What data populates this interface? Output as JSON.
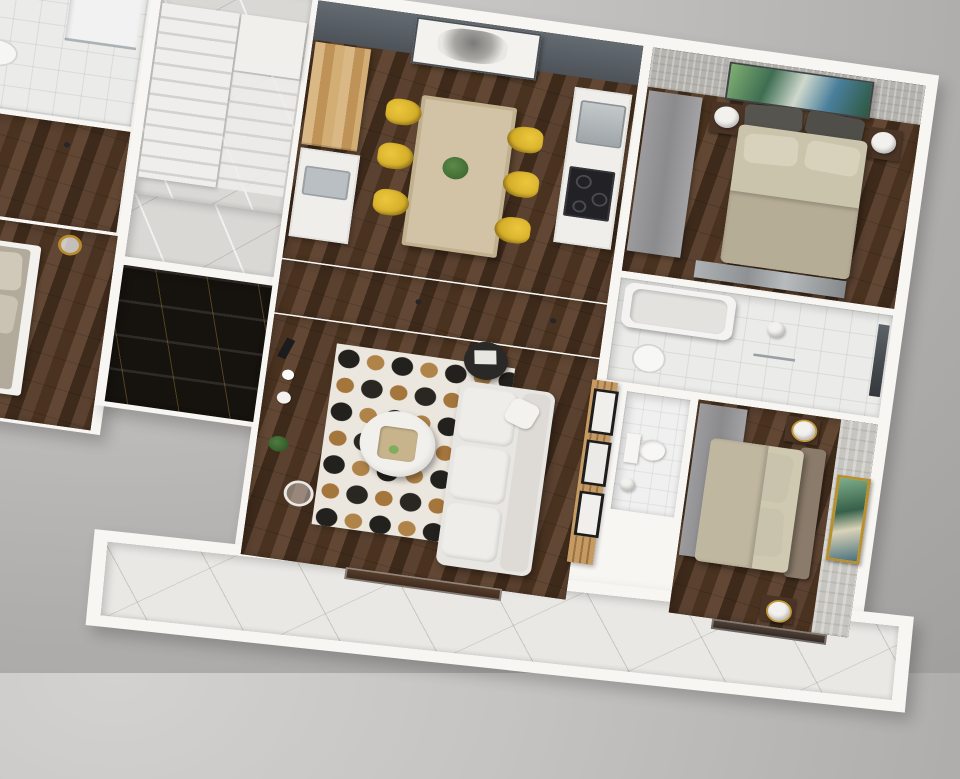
{
  "meta": {
    "description": "Photorealistic 3D top-down dollhouse render of an apartment floor plan on a gray studio backdrop",
    "view": "top-down 3D cutaway, plan rotated about 10 degrees clockwise",
    "visible_text": "none"
  },
  "palette": {
    "backdrop_gray_top": "#d4d2d0",
    "backdrop_gray_bottom": "#a09e9c",
    "wall_white": "#f7f6f3",
    "wood_floor_dark": "#4e3727",
    "accent_wall_slate": "#575e65",
    "chair_yellow": "#e1ba2e",
    "dining_table_wood": "#d2c3a6",
    "kitchen_cabinet_wood": "#cda774",
    "bedding_khaki": "#cbc4ac",
    "headboard_brown": "#8b7b6a",
    "wardrobe_gray": "#939395",
    "rug_base": "#ece7de",
    "rug_hex_black": "#23211e",
    "rug_hex_gold": "#b08449",
    "sofa_white": "#e8e6e2",
    "marble_light": "#eae8e5",
    "black_marble": "#16120e",
    "plant_green": "#2f5427",
    "art_gold_frame": "#b8912e"
  },
  "scene": {
    "rooms": [
      {
        "name": "neighbor-bathroom",
        "floor": "white tile",
        "items": [
          "vanity with basin",
          "leaning mirror",
          "shower tray"
        ]
      },
      {
        "name": "neighbor-hall",
        "floor": "dark wood",
        "items": [
          "white door"
        ]
      },
      {
        "name": "neighbor-bedroom",
        "floor": "dark wood",
        "items": [
          "gray double bed",
          "gold wire lamps",
          "white nightstand"
        ]
      },
      {
        "name": "stair-hall",
        "floor": "light marble",
        "items": [
          "white L-shaped staircase",
          "landing"
        ]
      },
      {
        "name": "stair-landing-corridor",
        "floor": "gray marble"
      },
      {
        "name": "stairwell-void",
        "floor": "black marble steps with gold veining",
        "items": [
          "glass railing"
        ]
      },
      {
        "name": "dining-kitchen",
        "floor": "dark walnut planks",
        "items": [
          "slate accent wall",
          "black-and-white portrait artwork",
          "tall wood cabinets",
          "white counter with sink",
          "counter with steel sink and black cooktop",
          "light wood dining table",
          "six yellow chairs",
          "green table plant"
        ]
      },
      {
        "name": "bedroom-1",
        "floor": "dark wood",
        "items": [
          "textured gray wallpaper",
          "colorful abstract painting",
          "gray wardrobe",
          "double bed with beige bedding",
          "two dark headboard cushions",
          "two dark nightstands",
          "two white sphere lamps",
          "mirrored sliding wardrobe"
        ]
      },
      {
        "name": "bathroom-tub",
        "floor": "white tile",
        "items": [
          "bathtub",
          "vanity with round basin",
          "window",
          "pendant light"
        ]
      },
      {
        "name": "hallway",
        "floor": "dark wood",
        "items": [
          "two white panel doors"
        ]
      },
      {
        "name": "living-room",
        "floor": "dark walnut planks",
        "items": [
          "white console sideboard with decor and plant",
          "arc floor lamp",
          "hexagon mosaic rug in black-white-gold",
          "round white coffee table with tray",
          "black round side table",
          "white three-seat sofa",
          "wood slat wall with three framed pictures"
        ]
      },
      {
        "name": "wc",
        "floor": "small white tile",
        "items": [
          "toilet",
          "floor lamp"
        ]
      },
      {
        "name": "bedroom-2",
        "floor": "dark wood",
        "items": [
          "stone-textured wallpaper",
          "gold-framed landscape art",
          "gray wardrobe",
          "double bed with brown headboard",
          "two nightstands",
          "two white-gold lamps"
        ]
      },
      {
        "name": "balcony",
        "floor": "white marble with gray veining",
        "items": [
          "green shrub planter left",
          "green shrub planter right",
          "sliding glass door",
          "bedroom window strip"
        ]
      }
    ]
  }
}
